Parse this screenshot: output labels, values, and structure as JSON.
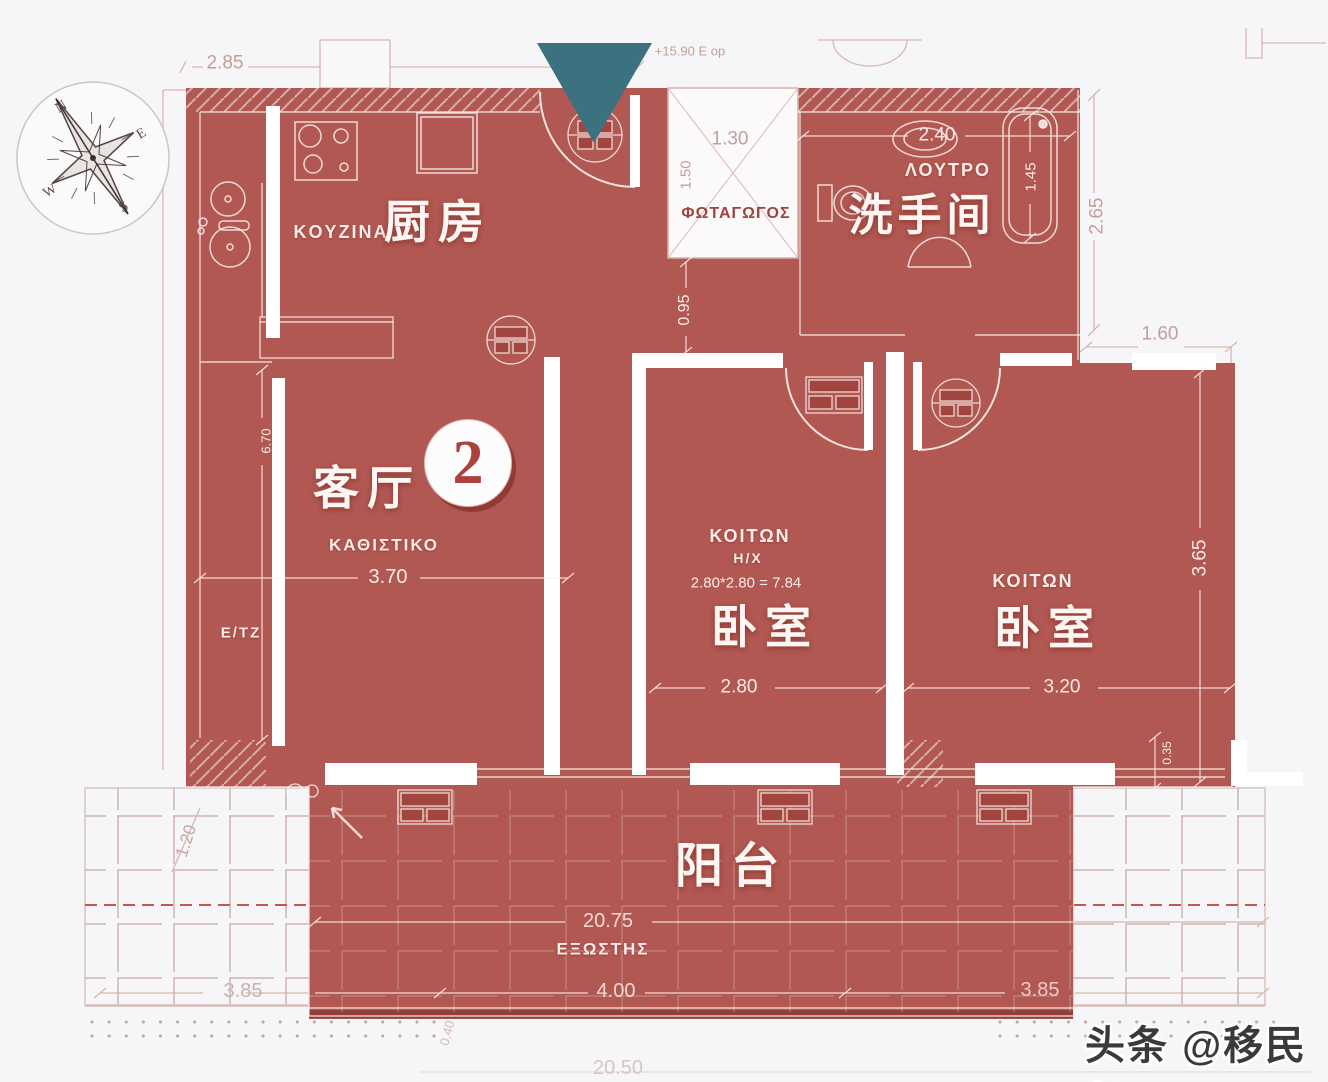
{
  "compass": {
    "n": "N",
    "e": "E",
    "s": "S",
    "w": "W"
  },
  "plan": {
    "elevation_note": "+15.90 E op",
    "unit_number": "2",
    "watermark": "头条 @移民帮"
  },
  "rooms": {
    "kitchen": {
      "greek": "KOYZINA",
      "cn": "厨房"
    },
    "bathroom": {
      "greek": "ΛΟΥΤΡΟ",
      "cn": "洗手间"
    },
    "lightwell": {
      "greek": "ΦΩΤΑΓΩΓΟΣ",
      "width": "1.30",
      "height": "1.50"
    },
    "living": {
      "greek": "ΚΑΘΙΣΤΙΚΟ",
      "cn": "客厅",
      "fixture": "E/TZ",
      "width": "3.70",
      "depth": "6.70"
    },
    "bedroom1": {
      "greek": "ΚΟΙΤΩΝ",
      "hx": "H/X",
      "area": "2.80*2.80 = 7.84",
      "cn": "卧室",
      "width": "2.80"
    },
    "bedroom2": {
      "greek": "ΚΟΙΤΩΝ",
      "cn": "卧室",
      "width": "3.20",
      "depth": "3.65"
    },
    "balcony": {
      "greek": "ΕΞΩΣΤΗΣ",
      "cn": "阳台",
      "length": "20.75",
      "section": "4.00"
    }
  },
  "dims": {
    "top_left": "2.85",
    "bath_width": "2.40",
    "tub_length": "1.45",
    "bath_depth": "2.65",
    "top_right": "1.60",
    "hall": "0.95",
    "parapet": "0.35",
    "bottom_left": "3.85",
    "bottom_right": "3.85",
    "terrace_depth": "1.20",
    "step": "0.40",
    "total_width": "20.50"
  },
  "colors": {
    "overlay_red": "#af524c",
    "entrance_teal": "#3c7280",
    "badge_number_red": "#ad423c",
    "blueprint_pink": "#d9b6b1"
  }
}
